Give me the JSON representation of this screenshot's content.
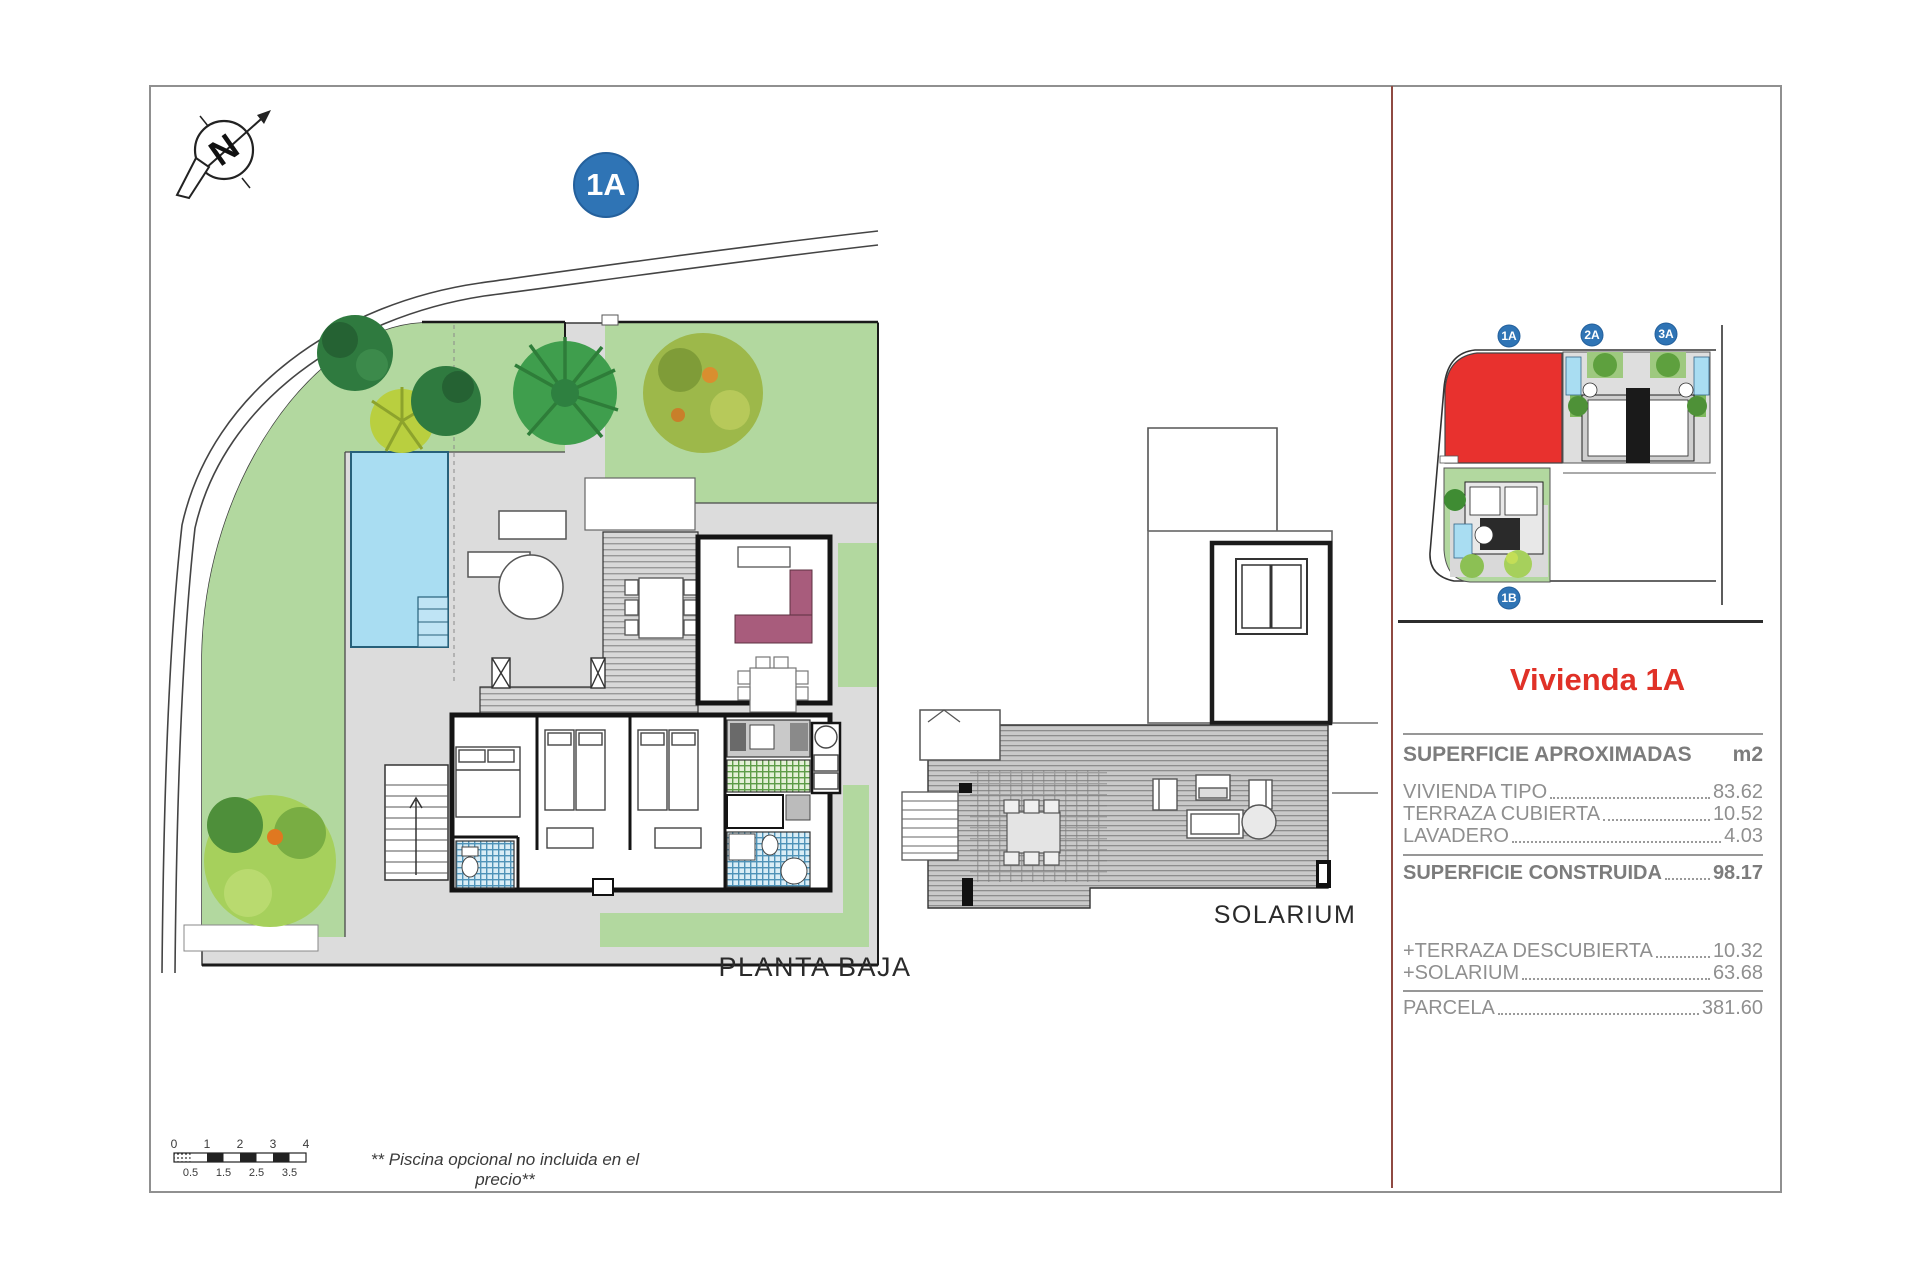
{
  "page": {
    "main_badge": "1A",
    "planta_baja_label": "PLANTA BAJA",
    "solarium_label": "SOLARIUM",
    "note": "** Piscina opcional no incluida en el precio**"
  },
  "north_arrow": {
    "letter": "N"
  },
  "scale_bar": {
    "top_ticks": [
      "0",
      "1",
      "2",
      "3",
      "4"
    ],
    "bottom_ticks": [
      "0.5",
      "1.5",
      "2.5",
      "3.5"
    ]
  },
  "site_map": {
    "badges": {
      "a1": "1A",
      "a2": "2A",
      "a3": "3A",
      "b1": "1B"
    },
    "highlight_color": "#e8312e"
  },
  "panel": {
    "title": "Vivienda 1A",
    "title_color": "#e03127",
    "table": {
      "header": {
        "label": "SUPERFICIE APROXIMADAS",
        "unit": "m2"
      },
      "rows": [
        {
          "label": "VIVIENDA TIPO",
          "value": "83.62"
        },
        {
          "label": "TERRAZA CUBIERTA ",
          "value": "10.52"
        },
        {
          "label": "LAVADERO ",
          "value": "4.03"
        }
      ],
      "total": {
        "label": "SUPERFICIE CONSTRUIDA",
        "value": "98.17"
      },
      "extras": [
        {
          "label": "+TERRAZA DESCUBIERTA",
          "value": "10.32"
        },
        {
          "label": "+SOLARIUM ",
          "value": "63.68"
        }
      ],
      "parcel": {
        "label": "PARCELA ",
        "value": "381.60"
      }
    }
  },
  "colors": {
    "badge_blue": "#2f74b5",
    "plot_red": "#e8312e",
    "garden_green": "#b2d89f",
    "pool_blue": "#a9ddf2",
    "terrace_gray": "#dcdcdc"
  }
}
